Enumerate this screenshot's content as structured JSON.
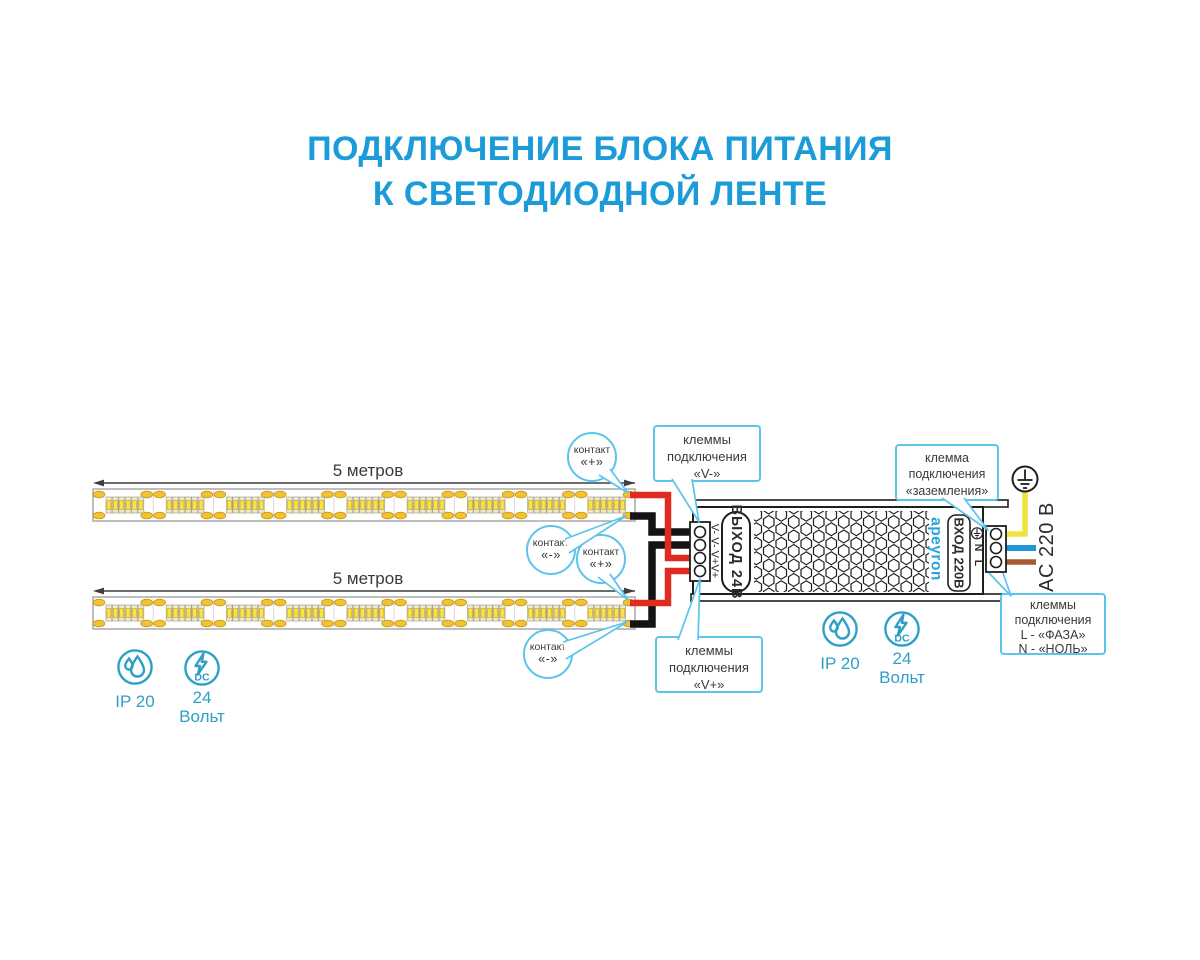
{
  "title": {
    "line1": "ПОДКЛЮЧЕНИЕ БЛОКА ПИТАНИЯ",
    "line2": "К СВЕТОДИОДНОЙ ЛЕНТЕ"
  },
  "strips": {
    "length_label": "5 метров"
  },
  "callouts": {
    "contact_plus_1": {
      "line1": "контакт",
      "line2": "«+»"
    },
    "contact_minus_1": {
      "line1": "контакт",
      "line2": "«-»"
    },
    "contact_plus_2": {
      "line1": "контакт",
      "line2": "«+»"
    },
    "contact_minus_2": {
      "line1": "контакт",
      "line2": "«-»"
    },
    "v_minus": {
      "line1": "клеммы",
      "line2": "подключения",
      "line3": "«V-»"
    },
    "v_plus": {
      "line1": "клеммы",
      "line2": "подключения",
      "line3": "«V+»"
    },
    "ground": {
      "line1": "клемма",
      "line2": "подключения",
      "line3": "«заземления»"
    },
    "phase_null": {
      "line1": "клеммы",
      "line2": "подключения",
      "line3": "L - «ФАЗА»",
      "line4": "N - «НОЛЬ»"
    }
  },
  "psu": {
    "output_label": "ВЫХОД 24В",
    "output_terminals": "V- V- V+V+",
    "brand": "apeyron",
    "input_label": "ВХОД 220В",
    "terminal_n": "N",
    "terminal_l": "L",
    "ac_label": "AC 220 В"
  },
  "badges": {
    "ip_rating": "IP 20",
    "dc_label": "DC",
    "voltage_line1": "24",
    "voltage_line2": "Вольт"
  },
  "colors": {
    "title-blue": "#1B9CD9",
    "callout-blue": "#5BC4EC",
    "icon-teal": "#2E9FC6",
    "text-dark": "#3A3A3A",
    "wire-red": "#E02B20",
    "wire-black": "#141414",
    "wire-yellow": "#F0E33C",
    "wire-blue": "#1E96D8",
    "wire-brown": "#A55A32",
    "pad-gold": "#F2C230",
    "led-yellow": "#F7E547"
  }
}
